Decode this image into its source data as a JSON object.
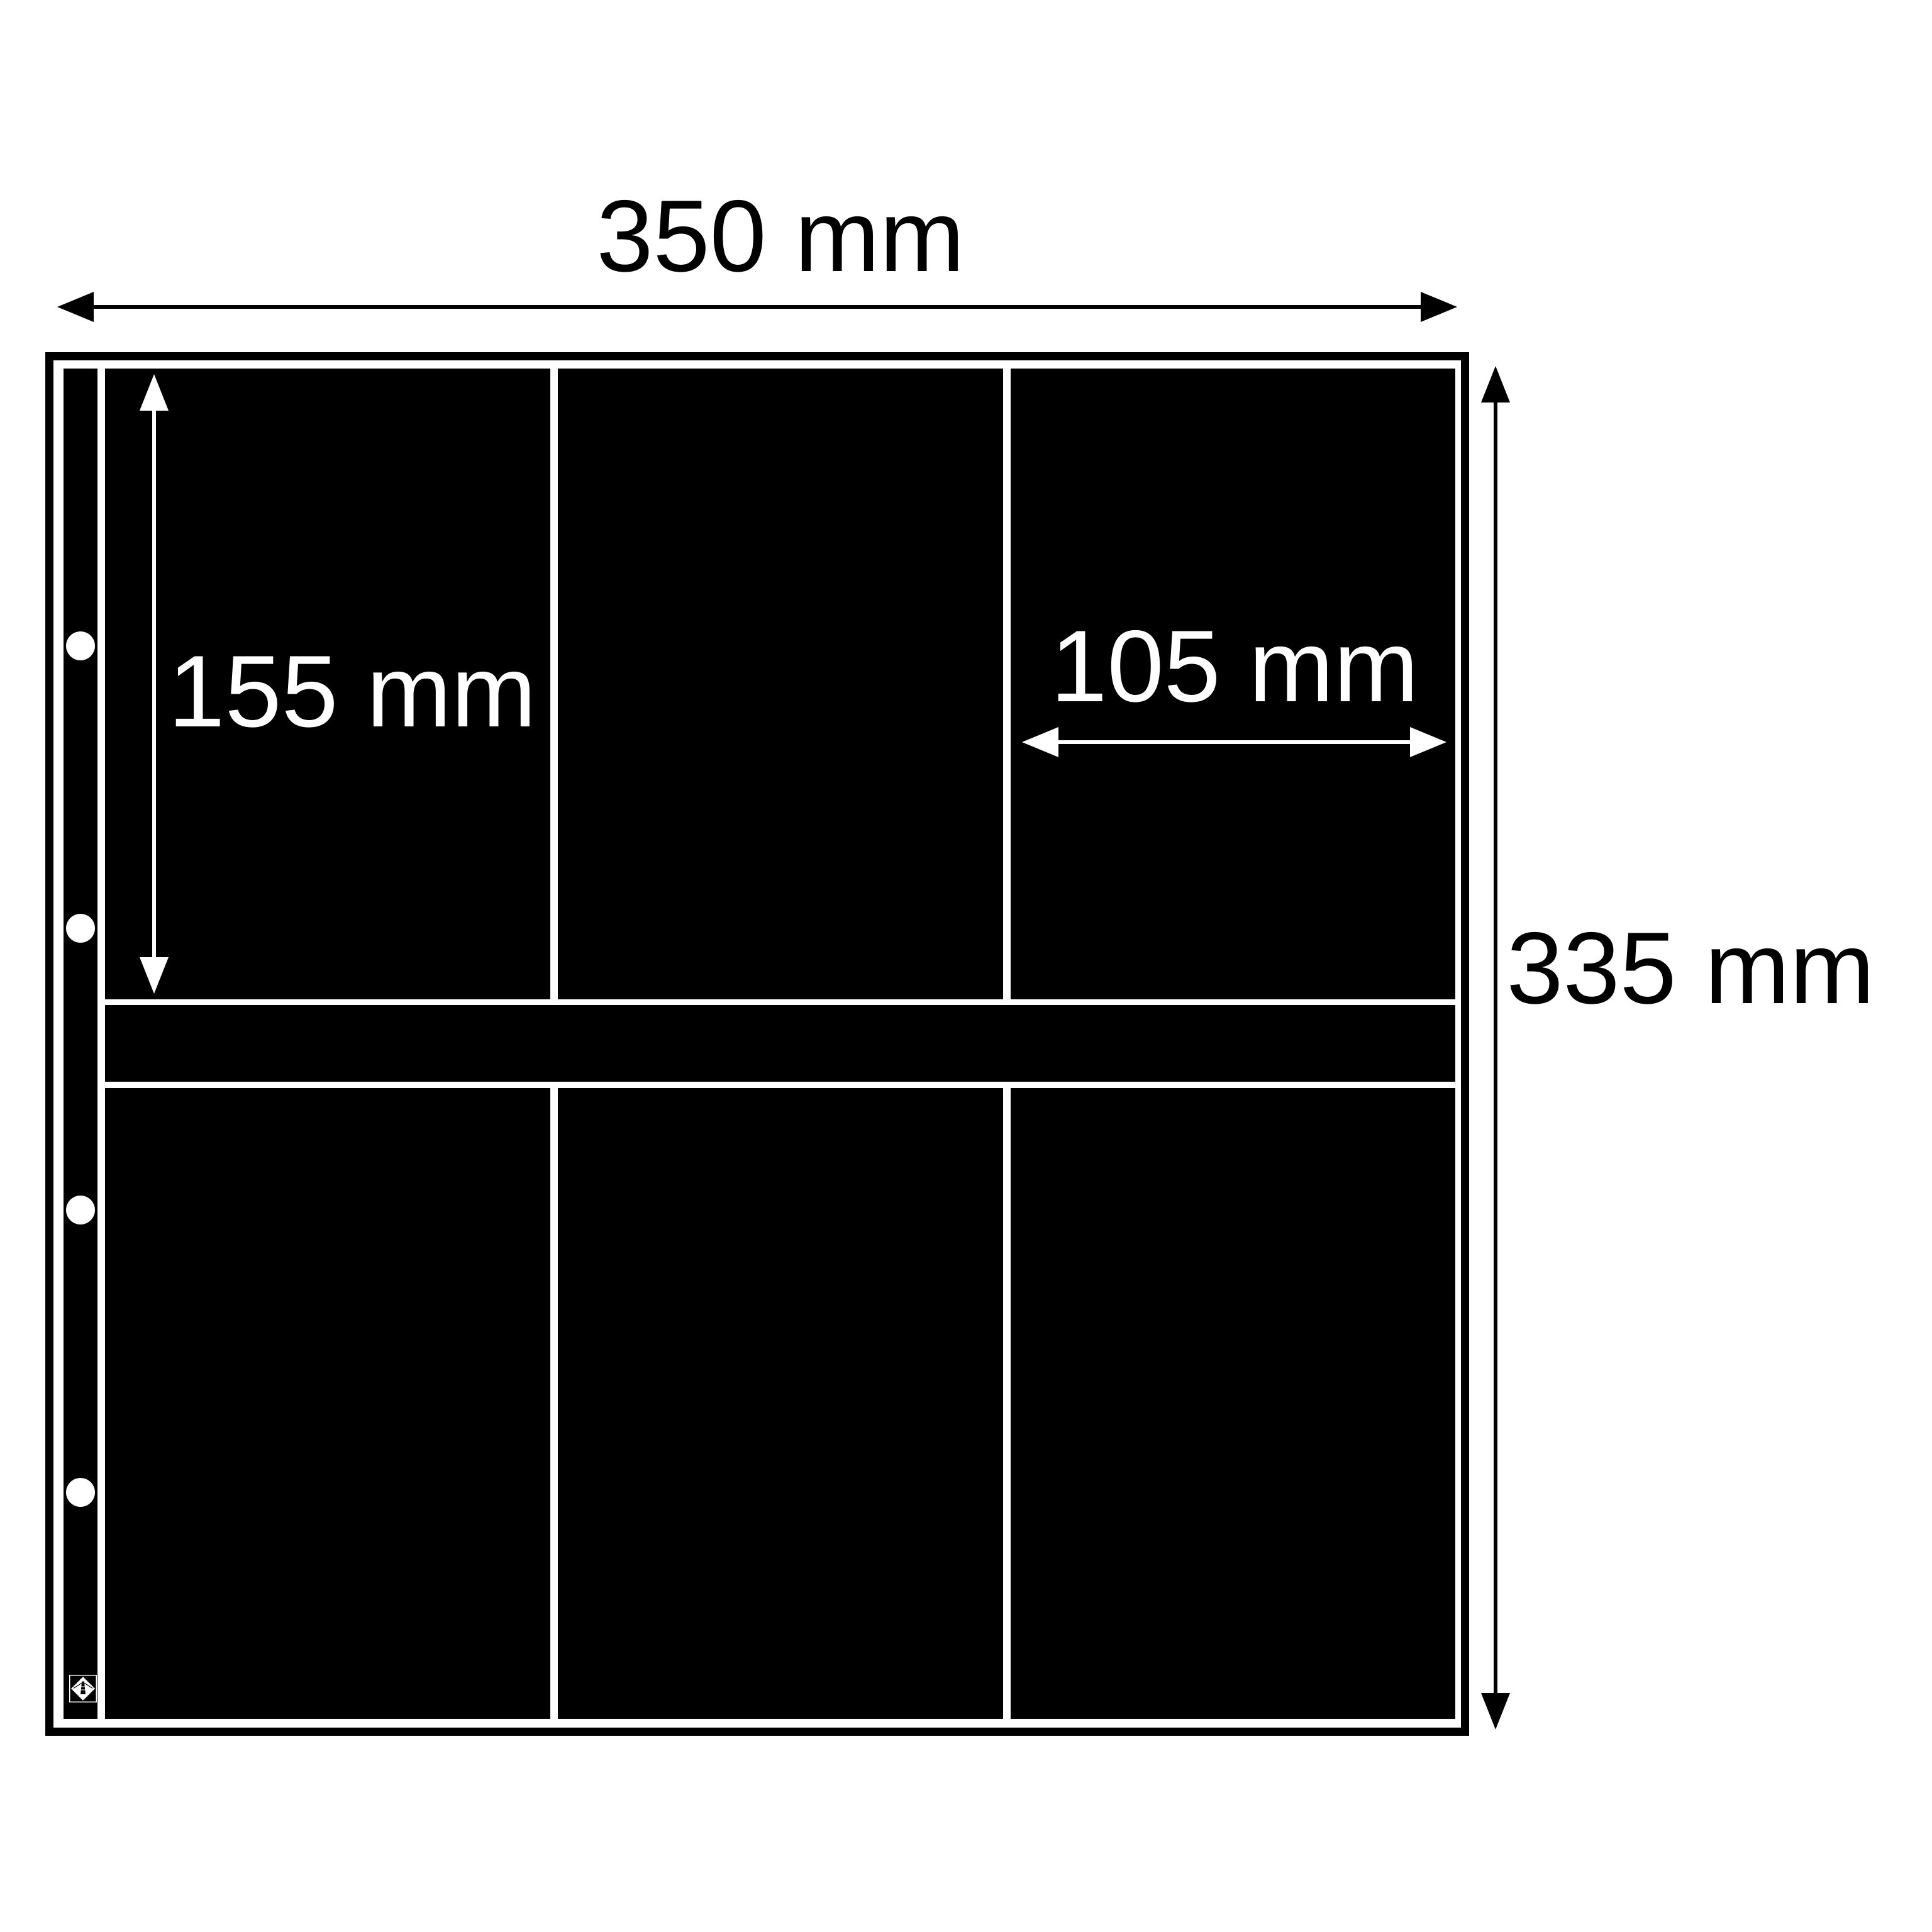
{
  "diagram": {
    "type": "album-page-dimension-diagram",
    "sheet": {
      "rows": 2,
      "pockets_per_row": 3,
      "binder_holes": 4,
      "background": "#ffffff",
      "pocket_color": "#000000",
      "outline_color": "#000000"
    },
    "labels": {
      "sheet_width": "350 mm",
      "pocket_height": "155 mm",
      "pocket_width": "105 mm",
      "sheet_height": "335 mm"
    },
    "label_colors": {
      "outside": "#000000",
      "inside_pocket": "#ffffff"
    },
    "icons": {
      "logo": "lighthouse-diamond-logo"
    }
  }
}
